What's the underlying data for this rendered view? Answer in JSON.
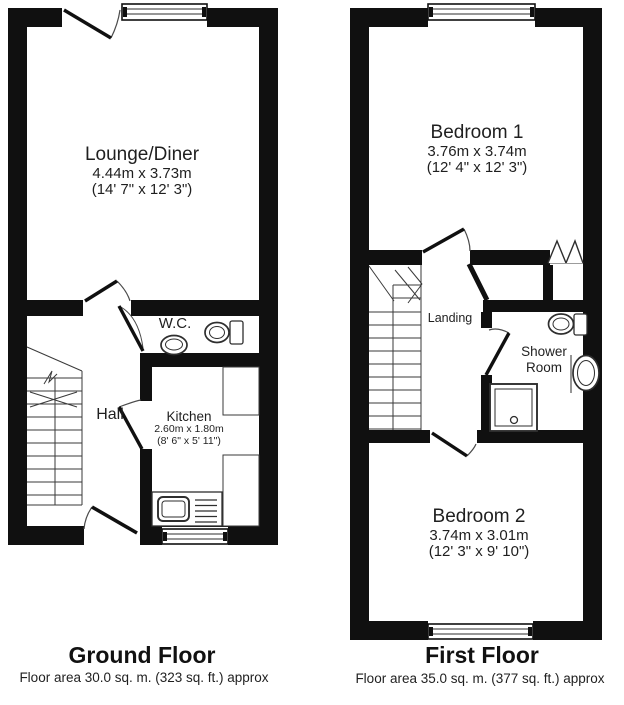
{
  "ground_floor": {
    "title": "Ground Floor",
    "area_note": "Floor area 30.0 sq. m. (323 sq. ft.) approx",
    "rooms": {
      "lounge_diner": {
        "name": "Lounge/Diner",
        "metric": "4.44m x 3.73m",
        "imperial": "(14' 7\" x 12' 3\")"
      },
      "wc": {
        "name": "W.C."
      },
      "hall": {
        "name": "Hall"
      },
      "kitchen": {
        "name": "Kitchen",
        "metric": "2.60m x 1.80m",
        "imperial": "(8' 6\" x 5' 11\")"
      }
    }
  },
  "first_floor": {
    "title": "First Floor",
    "area_note": "Floor area 35.0 sq. m. (377 sq. ft.) approx",
    "rooms": {
      "bedroom_1": {
        "name": "Bedroom 1",
        "metric": "3.76m x 3.74m",
        "imperial": "(12' 4\" x 12' 3\")"
      },
      "landing": {
        "name": "Landing"
      },
      "shower_room": {
        "name": "Shower Room"
      },
      "bedroom_2": {
        "name": "Bedroom 2",
        "metric": "3.74m x 3.01m",
        "imperial": "(12' 3\" x 9' 10\")"
      }
    }
  },
  "colors": {
    "walls": "#101010",
    "linework": "#383838",
    "background": "#ffffff",
    "text": "#1a1a1a"
  }
}
